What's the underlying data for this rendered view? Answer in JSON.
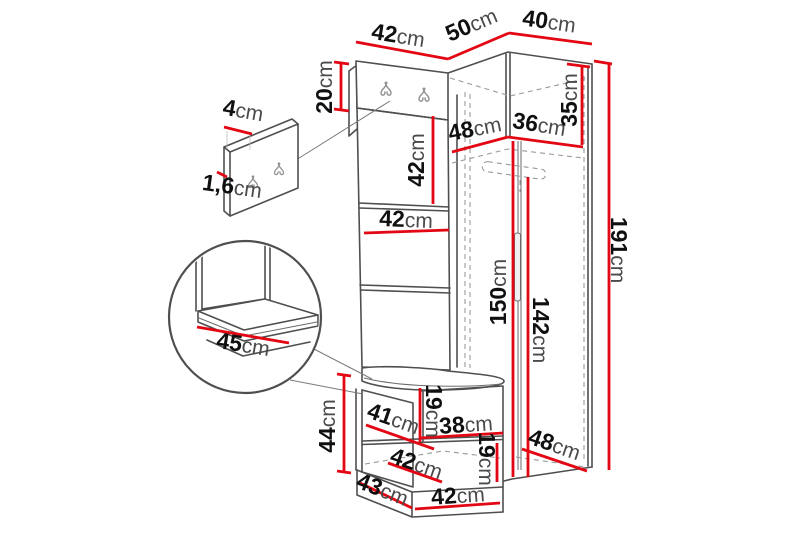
{
  "diagram": {
    "kind": "furniture-dimension-diagram",
    "subject": "corner hallway set: hook panel, wardrobe, bench with details",
    "unit": "cm"
  },
  "colors": {
    "dimension_line": "#e30613",
    "structure_line": "#4f4f4f",
    "dashed_line": "#9a9a9a",
    "number_text": "#101010",
    "unit_text": "#4a4a4a",
    "background": "#ffffff"
  },
  "dimensions": [
    {
      "id": "top-width-42",
      "value": "42",
      "unit": "cm",
      "x": 398,
      "y": 37,
      "rot": 9,
      "lines": [
        [
          356,
          42,
          448,
          59
        ]
      ]
    },
    {
      "id": "top-depth-50",
      "value": "50",
      "unit": "cm",
      "x": 472,
      "y": 26,
      "rot": -23,
      "lines": [
        [
          448,
          59,
          509,
          33
        ]
      ]
    },
    {
      "id": "top-width-40",
      "value": "40",
      "unit": "cm",
      "x": 549,
      "y": 23,
      "rot": 8,
      "lines": [
        [
          509,
          33,
          592,
          44
        ]
      ]
    },
    {
      "id": "hook-panel-height-20",
      "value": "20",
      "unit": "cm",
      "x": 326,
      "y": 87,
      "rot": -90,
      "lines": [
        [
          341,
          64,
          341,
          110
        ],
        [
          334,
          62,
          349,
          64
        ],
        [
          334,
          109,
          349,
          111
        ]
      ]
    },
    {
      "id": "hook-plate-width-4",
      "value": "4",
      "unit": "cm",
      "x": 243,
      "y": 112,
      "rot": 10,
      "lines": [
        [
          224,
          127,
          252,
          134
        ]
      ]
    },
    {
      "id": "hook-plate-thickness-1-6",
      "value": "1,6",
      "unit": "cm",
      "x": 232,
      "y": 188,
      "rot": 8,
      "lines": [
        [
          217,
          172,
          227,
          177
        ]
      ]
    },
    {
      "id": "panel-section-height-42",
      "value": "42",
      "unit": "cm",
      "x": 418,
      "y": 160,
      "rot": -90,
      "lines": [
        [
          433,
          116,
          433,
          204
        ]
      ]
    },
    {
      "id": "panel-width-42",
      "value": "42",
      "unit": "cm",
      "x": 406,
      "y": 221,
      "rot": 2,
      "lines": [
        [
          364,
          233,
          449,
          230
        ]
      ]
    },
    {
      "id": "wardrobe-top-depth-48",
      "value": "48",
      "unit": "cm",
      "x": 475,
      "y": 130,
      "rot": -11,
      "lines": [
        [
          452,
          152,
          508,
          137
        ]
      ]
    },
    {
      "id": "wardrobe-top-width-36",
      "value": "36",
      "unit": "cm",
      "x": 539,
      "y": 126,
      "rot": 9,
      "lines": [
        [
          508,
          137,
          583,
          147
        ]
      ]
    },
    {
      "id": "top-shelf-height-35",
      "value": "35",
      "unit": "cm",
      "x": 571,
      "y": 100,
      "rot": -90,
      "lines": [
        [
          582,
          66,
          582,
          145
        ],
        [
          567,
          64,
          590,
          67
        ]
      ]
    },
    {
      "id": "wardrobe-height-191",
      "value": "191",
      "unit": "cm",
      "x": 617,
      "y": 250,
      "rot": 90,
      "lines": [
        [
          609,
          64,
          609,
          470
        ],
        [
          594,
          61,
          612,
          64
        ]
      ]
    },
    {
      "id": "interior-height-150",
      "value": "150",
      "unit": "cm",
      "x": 500,
      "y": 292,
      "rot": -90,
      "lines": [
        [
          513,
          141,
          513,
          477
        ]
      ]
    },
    {
      "id": "door-height-142",
      "value": "142",
      "unit": "cm",
      "x": 539,
      "y": 330,
      "rot": 90,
      "lines": [
        [
          528,
          177,
          528,
          477
        ]
      ]
    },
    {
      "id": "wardrobe-bottom-depth-48",
      "value": "48",
      "unit": "cm",
      "x": 554,
      "y": 446,
      "rot": 19,
      "lines": [
        [
          522,
          449,
          587,
          471
        ]
      ]
    },
    {
      "id": "bench-height-44",
      "value": "44",
      "unit": "cm",
      "x": 329,
      "y": 426,
      "rot": -90,
      "lines": [
        [
          344,
          376,
          344,
          473
        ],
        [
          337,
          374,
          351,
          376
        ],
        [
          337,
          471,
          351,
          473
        ]
      ]
    },
    {
      "id": "bench-opening-width-41",
      "value": "41",
      "unit": "cm",
      "x": 393,
      "y": 420,
      "rot": 19,
      "lines": [
        [
          366,
          425,
          434,
          449
        ]
      ]
    },
    {
      "id": "bench-opening-height-19",
      "value": "19",
      "unit": "cm",
      "x": 432,
      "y": 411,
      "rot": 90,
      "lines": [
        [
          420,
          388,
          420,
          442
        ]
      ]
    },
    {
      "id": "bench-shelf-width-38",
      "value": "38",
      "unit": "cm",
      "x": 466,
      "y": 426,
      "rot": -4,
      "lines": [
        [
          420,
          438,
          503,
          433
        ]
      ]
    },
    {
      "id": "bench-inner-width-42",
      "value": "42",
      "unit": "cm",
      "x": 416,
      "y": 465,
      "rot": 19,
      "lines": [
        [
          388,
          463,
          442,
          482
        ]
      ]
    },
    {
      "id": "bench-lower-height-19",
      "value": "19",
      "unit": "cm",
      "x": 485,
      "y": 459,
      "rot": 90,
      "lines": [
        [
          497,
          443,
          497,
          482
        ]
      ]
    },
    {
      "id": "bench-base-depth-43",
      "value": "43",
      "unit": "cm",
      "x": 382,
      "y": 491,
      "rot": 21,
      "lines": [
        [
          360,
          483,
          412,
          508
        ]
      ]
    },
    {
      "id": "bench-base-width-42",
      "value": "42",
      "unit": "cm",
      "x": 458,
      "y": 497,
      "rot": -4,
      "lines": [
        [
          415,
          509,
          500,
          503
        ]
      ]
    },
    {
      "id": "seat-depth-45",
      "value": "45",
      "unit": "cm",
      "x": 243,
      "y": 346,
      "rot": 9,
      "lines": [
        [
          197,
          327,
          289,
          343
        ]
      ]
    }
  ]
}
